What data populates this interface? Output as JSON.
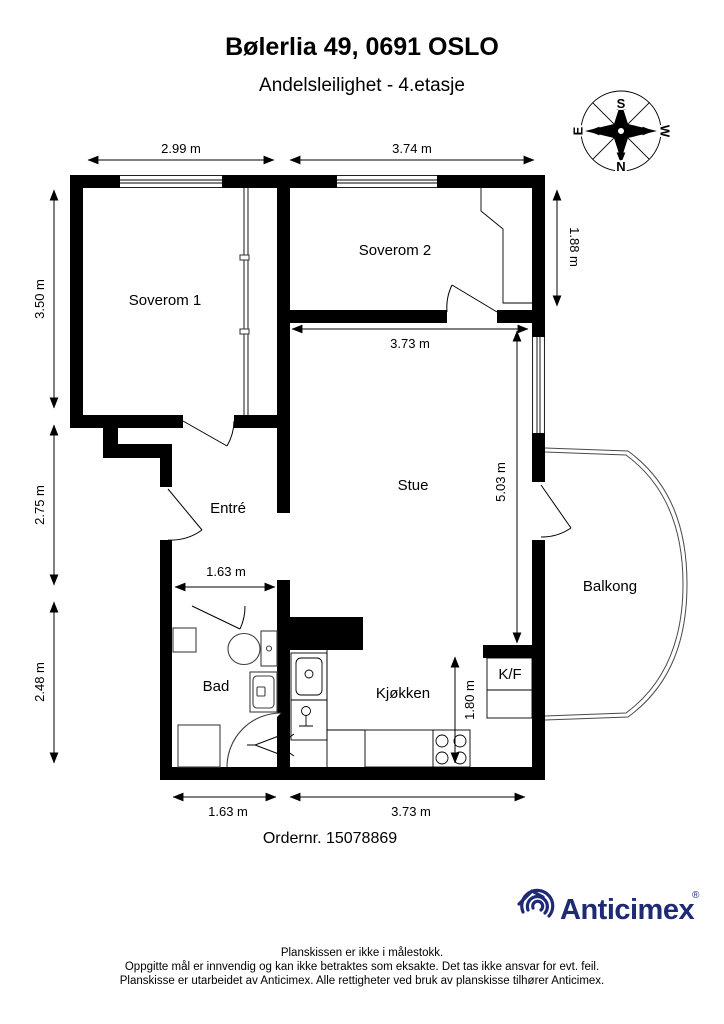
{
  "header": {
    "title": "Bølerlia 49, 0691 OSLO",
    "subtitle": "Andelsleilighet  - 4.etasje"
  },
  "compass": {
    "north": "N",
    "south": "S",
    "east": "E",
    "west": "W"
  },
  "plan": {
    "rooms": {
      "soverom1": "Soverom 1",
      "soverom2": "Soverom 2",
      "stue": "Stue",
      "entre": "Entré",
      "bad": "Bad",
      "kjokken": "Kjøkken",
      "kf": "K/F",
      "balkong": "Balkong"
    },
    "dimensions": {
      "top_soverom1": "2.99 m",
      "top_soverom2": "3.74 m",
      "left_soverom1": "3.50 m",
      "left_entre": "2.75 m",
      "left_bad": "2.48 m",
      "right_soverom2": "1.88 m",
      "stue_width": "3.73 m",
      "stue_depth": "5.03 m",
      "entre_width": "1.63 m",
      "kjokken_depth": "1.80 m",
      "bottom_bad": "1.63 m",
      "bottom_kjokken": "3.73 m"
    }
  },
  "order_number": "Ordernr. 15078869",
  "branding": {
    "name": "Anticimex",
    "registered": "®",
    "color": "#1f2a77"
  },
  "footer": {
    "line1": "Planskissen er ikke i målestokk.",
    "line2": "Oppgitte mål er innvendig og kan ikke betraktes som eksakte. Det tas ikke ansvar for evt. feil.",
    "line3": "Planskisse er utarbeidet av Anticimex. Alle rettigheter ved bruk av planskisse tilhører Anticimex."
  }
}
